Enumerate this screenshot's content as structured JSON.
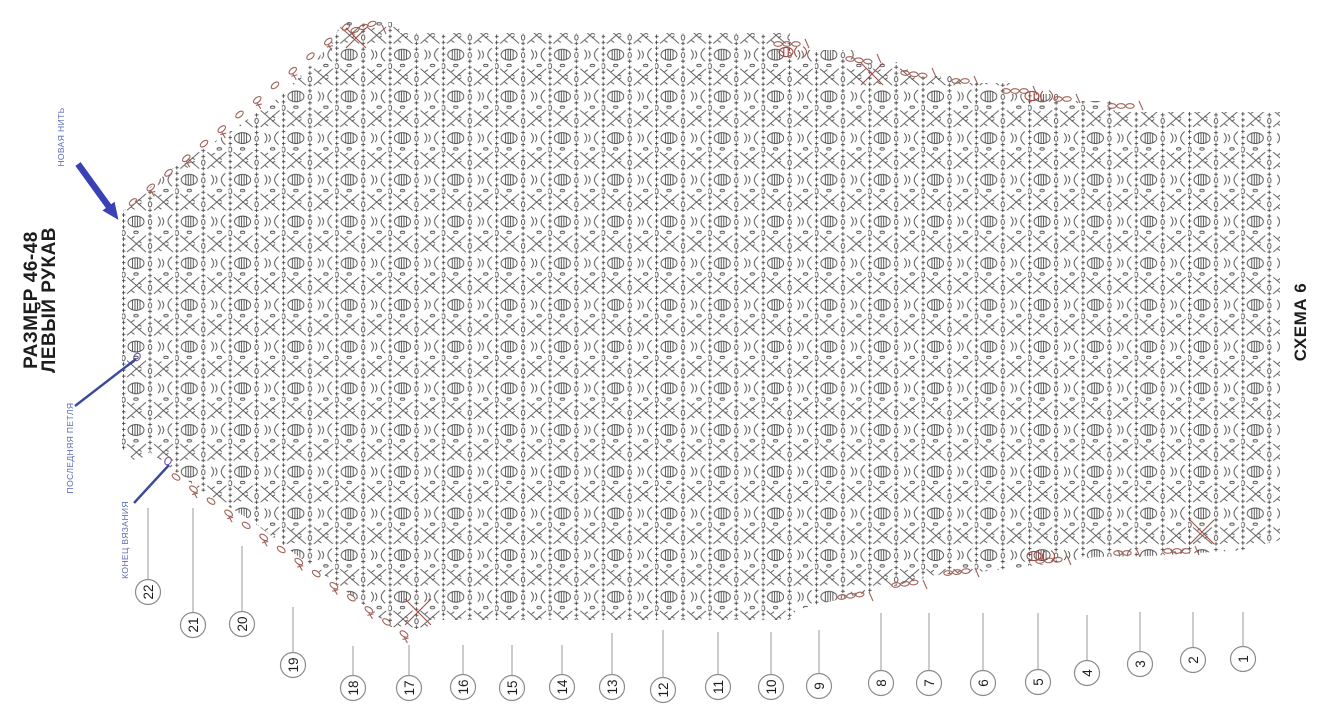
{
  "page": {
    "background": "#ffffff",
    "width": 1318,
    "height": 710
  },
  "title": {
    "line1": "РАЗМЕР 46-48",
    "line2": "ЛЕВЫЙ РУКАВ"
  },
  "schema_label": "СХЕМА 6",
  "annotations": {
    "new_thread": {
      "label": "НОВАЯ НИТЬ",
      "x": 64,
      "y": 137
    },
    "last_loop": {
      "label": "ПОСЛЕДНЯЯ ПЕТЛЯ",
      "x": 73,
      "y": 448
    },
    "end_of_knitting": {
      "label": "КОНЕЦ ВЯЗАНИЯ",
      "x": 128,
      "y": 540
    },
    "arrow": {
      "x1": 78,
      "y1": 164,
      "x2": 112,
      "y2": 211
    },
    "pointer_lines": [
      {
        "x1": 75,
        "y1": 406,
        "x2": 136,
        "y2": 359
      },
      {
        "x1": 134,
        "y1": 503,
        "x2": 169,
        "y2": 465
      }
    ]
  },
  "colors": {
    "symbol": "#4a4a4a",
    "accent": "#a2625a",
    "accent_red": "#9e4f46",
    "annotation_blue": "#3a4a9b",
    "arrow_blue": "#3a41b5",
    "leader_gray": "#9a9a9a",
    "circle_stroke": "#8c8c8c",
    "text_dark": "#1d1d1d",
    "violet": "#7a5fae",
    "background": "#ffffff"
  },
  "chart": {
    "type": "crochet-pattern-diagram",
    "rows_total": 22,
    "stitch_symbols": [
      "puff-stitch",
      "chain-loop",
      "single-crochet-plus",
      "crossed-stitch",
      "shell-arc"
    ],
    "outline": [
      [
        122,
        212
      ],
      [
        170,
        170
      ],
      [
        225,
        135
      ],
      [
        280,
        97
      ],
      [
        330,
        45
      ],
      [
        342,
        22
      ],
      [
        398,
        22
      ],
      [
        400,
        33
      ],
      [
        790,
        33
      ],
      [
        790,
        50
      ],
      [
        855,
        50
      ],
      [
        855,
        62
      ],
      [
        908,
        62
      ],
      [
        908,
        76
      ],
      [
        960,
        76
      ],
      [
        960,
        83
      ],
      [
        1010,
        83
      ],
      [
        1010,
        94
      ],
      [
        1062,
        94
      ],
      [
        1062,
        101
      ],
      [
        1115,
        101
      ],
      [
        1115,
        112
      ],
      [
        1280,
        112
      ],
      [
        1280,
        540
      ],
      [
        1245,
        550
      ],
      [
        1150,
        556
      ],
      [
        1095,
        557
      ],
      [
        1040,
        565
      ],
      [
        988,
        571
      ],
      [
        935,
        575
      ],
      [
        884,
        589
      ],
      [
        840,
        599
      ],
      [
        796,
        610
      ],
      [
        790,
        620
      ],
      [
        430,
        620
      ],
      [
        428,
        631
      ],
      [
        396,
        631
      ],
      [
        350,
        594
      ],
      [
        299,
        557
      ],
      [
        249,
        519
      ],
      [
        199,
        489
      ],
      [
        168,
        466
      ],
      [
        150,
        452
      ],
      [
        136,
        462
      ],
      [
        122,
        449
      ]
    ],
    "row_markers": [
      {
        "n": 1,
        "x": 1243,
        "y": 659,
        "t": 612
      },
      {
        "n": 2,
        "x": 1193,
        "y": 660,
        "t": 612
      },
      {
        "n": 3,
        "x": 1140,
        "y": 664,
        "t": 612
      },
      {
        "n": 4,
        "x": 1087,
        "y": 673,
        "t": 615
      },
      {
        "n": 5,
        "x": 1038,
        "y": 682,
        "t": 613
      },
      {
        "n": 6,
        "x": 983,
        "y": 683,
        "t": 613
      },
      {
        "n": 7,
        "x": 929,
        "y": 683,
        "t": 613
      },
      {
        "n": 8,
        "x": 881,
        "y": 683,
        "t": 613
      },
      {
        "n": 9,
        "x": 819,
        "y": 686,
        "t": 630
      },
      {
        "n": 10,
        "x": 771,
        "y": 687,
        "t": 632
      },
      {
        "n": 11,
        "x": 718,
        "y": 687,
        "t": 632
      },
      {
        "n": 12,
        "x": 663,
        "y": 690,
        "t": 630
      },
      {
        "n": 13,
        "x": 612,
        "y": 687,
        "t": 633
      },
      {
        "n": 14,
        "x": 562,
        "y": 687,
        "t": 645
      },
      {
        "n": 15,
        "x": 512,
        "y": 688,
        "t": 645
      },
      {
        "n": 16,
        "x": 463,
        "y": 687,
        "t": 645
      },
      {
        "n": 17,
        "x": 409,
        "y": 688,
        "t": 645
      },
      {
        "n": 18,
        "x": 353,
        "y": 688,
        "t": 646
      },
      {
        "n": 19,
        "x": 293,
        "y": 665,
        "t": 607
      },
      {
        "n": 20,
        "x": 242,
        "y": 624,
        "t": 546
      },
      {
        "n": 21,
        "x": 193,
        "y": 625,
        "t": 508
      },
      {
        "n": 22,
        "x": 148,
        "y": 592,
        "t": 508
      }
    ],
    "edge_chains": [
      {
        "x1": 133,
        "y1": 202,
        "x2": 346,
        "y2": 27,
        "n": 13,
        "bars": true
      },
      {
        "x1": 176,
        "y1": 477,
        "x2": 404,
        "y2": 634,
        "n": 14,
        "bars": true
      }
    ],
    "step_chains": [
      {
        "x": 778,
        "y": 44,
        "a": 0,
        "n": 3
      },
      {
        "x": 850,
        "y": 59,
        "a": 8,
        "n": 3
      },
      {
        "x": 905,
        "y": 73,
        "a": 8,
        "n": 3
      },
      {
        "x": 956,
        "y": 81,
        "a": 0,
        "n": 2
      },
      {
        "x": 1006,
        "y": 91,
        "a": 0,
        "n": 3
      },
      {
        "x": 1058,
        "y": 99,
        "a": 0,
        "n": 2
      },
      {
        "x": 1112,
        "y": 106,
        "a": 0,
        "n": 3
      },
      {
        "x": 355,
        "y": 30,
        "a": -20,
        "n": 3
      },
      {
        "x": 842,
        "y": 597,
        "a": -8,
        "n": 3
      },
      {
        "x": 896,
        "y": 585,
        "a": -8,
        "n": 3
      },
      {
        "x": 948,
        "y": 573,
        "a": -6,
        "n": 3
      },
      {
        "x": 1040,
        "y": 561,
        "a": -4,
        "n": 3
      },
      {
        "x": 1118,
        "y": 553,
        "a": 0,
        "n": 2
      },
      {
        "x": 1168,
        "y": 551,
        "a": 0,
        "n": 3
      }
    ],
    "crosses": [
      {
        "x": 418,
        "y": 612,
        "s": 13
      },
      {
        "x": 872,
        "y": 74,
        "s": 11
      },
      {
        "x": 1202,
        "y": 532,
        "s": 12
      },
      {
        "x": 356,
        "y": 38,
        "s": 10
      }
    ],
    "puff_accents": [
      {
        "x": 1032,
        "y": 96
      },
      {
        "x": 1034,
        "y": 556
      },
      {
        "x": 786,
        "y": 52
      }
    ],
    "dots": [
      {
        "x": 137,
        "y": 357
      },
      {
        "x": 168,
        "y": 461
      }
    ]
  }
}
